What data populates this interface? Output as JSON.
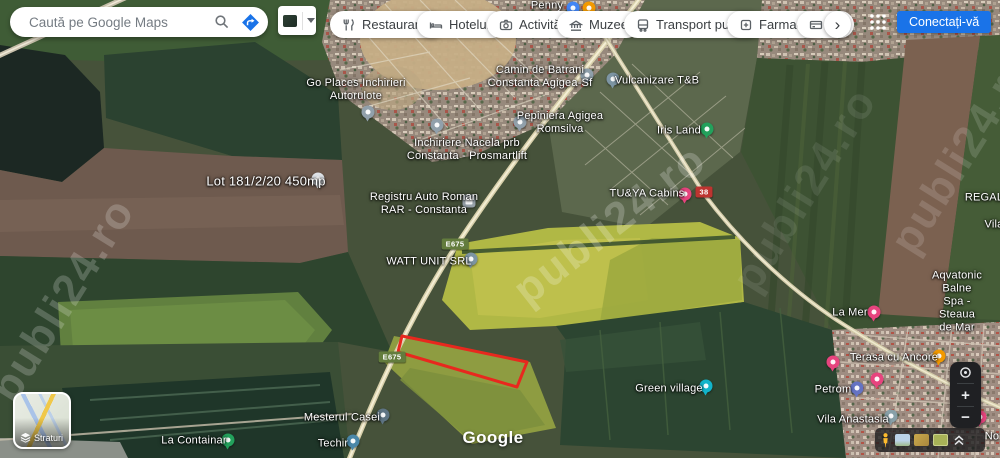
{
  "app": {
    "title": "Google Maps satellite view"
  },
  "header": {
    "search": {
      "placeholder": "Caută pe Google Maps"
    },
    "chips": [
      {
        "label": "Restaurante",
        "icon": "restaurants-icon"
      },
      {
        "label": "Hoteluri",
        "icon": "hotels-icon"
      },
      {
        "label": "Activități",
        "icon": "activities-icon"
      },
      {
        "label": "Muzee",
        "icon": "museums-icon"
      },
      {
        "label": "Transport public",
        "icon": "transit-icon"
      },
      {
        "label": "Farmacii",
        "icon": "pharmacies-icon"
      },
      {
        "label": "Ba",
        "icon": "atm-icon",
        "truncated": true
      }
    ],
    "chips_scroll": "›",
    "signin_label": "Conectați-vă"
  },
  "map": {
    "google_watermark": "Google",
    "site_watermark": "publi24.ro",
    "area_outline_points": "402,336 527,362 517,387 398,352",
    "area_outline_color": "#e8281e",
    "road_badges": [
      {
        "text": "E675",
        "x": 455,
        "y": 244,
        "style": "european"
      },
      {
        "text": "E675",
        "x": 392,
        "y": 357,
        "style": "european"
      },
      {
        "text": "38",
        "x": 704,
        "y": 192,
        "style": "national"
      }
    ],
    "labels": [
      {
        "text": "Penny",
        "x": 547,
        "y": 6
      },
      {
        "text": "Go Places Inchirieri\nAutorulote",
        "x": 356,
        "y": 90
      },
      {
        "text": "Camin de Batrani\nConstanta Agigea-Sf",
        "x": 540,
        "y": 77
      },
      {
        "text": "Vulcanizare T&B",
        "x": 657,
        "y": 81
      },
      {
        "text": "Pepiniera Agigea\nRomsilva",
        "x": 560,
        "y": 123
      },
      {
        "text": "Iris Land",
        "x": 679,
        "y": 131
      },
      {
        "text": "Inchiriere Nacela prb\nConstanta - Prosmartlift",
        "x": 467,
        "y": 150
      },
      {
        "text": "Lot 181/2/20 450mp",
        "x": 266,
        "y": 181
      },
      {
        "text": "Registru Auto Roman\nRAR - Constanta",
        "x": 424,
        "y": 204
      },
      {
        "text": "TU&YA Cabins",
        "x": 647,
        "y": 194
      },
      {
        "text": "WATT UNIT SRL",
        "x": 429,
        "y": 262
      },
      {
        "text": "REGAL",
        "x": 984,
        "y": 198
      },
      {
        "text": "Vila",
        "x": 994,
        "y": 225
      },
      {
        "text": "Aqvatonic Balne\nSpa - Steaua de Mar",
        "x": 957,
        "y": 302
      },
      {
        "text": "La Mer",
        "x": 850,
        "y": 313
      },
      {
        "text": "Terasa cu Ancore",
        "x": 894,
        "y": 358
      },
      {
        "text": "Green village",
        "x": 669,
        "y": 389
      },
      {
        "text": "Petrom",
        "x": 833,
        "y": 390
      },
      {
        "text": "Vila Anastasia",
        "x": 853,
        "y": 420
      },
      {
        "text": "Mesterul Casei",
        "x": 342,
        "y": 418
      },
      {
        "text": "La Containar",
        "x": 194,
        "y": 441
      },
      {
        "text": "Techir",
        "x": 333,
        "y": 444
      },
      {
        "text": "No",
        "x": 992,
        "y": 437
      }
    ],
    "pins": [
      {
        "name": "penny-shopping-pin",
        "color": "#4285f4",
        "x": 573,
        "y": 8
      },
      {
        "name": "orange-marker-pin",
        "color": "#f29900",
        "x": 589,
        "y": 8
      },
      {
        "name": "go-places-pin",
        "color": "#91a0ab",
        "x": 368,
        "y": 112
      },
      {
        "name": "camin-pin",
        "color": "#8fa0ab",
        "x": 587,
        "y": 75
      },
      {
        "name": "vulcanizare-pin",
        "color": "#7d95a3",
        "x": 613,
        "y": 79
      },
      {
        "name": "pepiniera-pin",
        "color": "#91a0ab",
        "x": 520,
        "y": 122
      },
      {
        "name": "nacela-pin",
        "color": "#91a0ab",
        "x": 437,
        "y": 125
      },
      {
        "name": "iris-land-park-pin",
        "color": "#23a15c",
        "x": 707,
        "y": 129
      },
      {
        "name": "lot-pin",
        "color": "#dfe3e8",
        "x": 318,
        "y": 179
      },
      {
        "name": "registru-building-icon",
        "color": "#97a1a9",
        "x": 469,
        "y": 201
      },
      {
        "name": "tuya-hotel-pin",
        "color": "#e7447e",
        "x": 685,
        "y": 194
      },
      {
        "name": "watt-unit-pin",
        "color": "#7d95a3",
        "x": 471,
        "y": 259
      },
      {
        "name": "la-mer-hotel-pin",
        "color": "#e7447e",
        "x": 874,
        "y": 312
      },
      {
        "name": "town-hotel-pin",
        "color": "#e7447e",
        "x": 833,
        "y": 362
      },
      {
        "name": "terasa-restaurant-pin",
        "color": "#f29900",
        "x": 939,
        "y": 356
      },
      {
        "name": "green-village-pin",
        "color": "#12b5cb",
        "x": 706,
        "y": 386
      },
      {
        "name": "petrom-gas-pin",
        "color": "#6573c3",
        "x": 857,
        "y": 388
      },
      {
        "name": "hotel-pin-2",
        "color": "#e7447e",
        "x": 877,
        "y": 379
      },
      {
        "name": "vila-anastasia-pin",
        "color": "#87a0a8",
        "x": 891,
        "y": 416
      },
      {
        "name": "hotel-pin-3",
        "color": "#e7447e",
        "x": 980,
        "y": 417
      },
      {
        "name": "mesterul-casei-pin",
        "color": "#5e7483",
        "x": 383,
        "y": 415
      },
      {
        "name": "techir-pin",
        "color": "#4a87a8",
        "x": 353,
        "y": 441
      },
      {
        "name": "la-containar-pin",
        "color": "#23a15c",
        "x": 228,
        "y": 440
      }
    ]
  },
  "controls": {
    "layers_label": "Straturi",
    "zoom_in_label": "+",
    "zoom_out_label": "−"
  },
  "colors": {
    "signin_blue": "#1a73e8",
    "route_badge_green": "#637c3d",
    "road_badge_red": "#bd3430",
    "area_outline_red": "#e8281e"
  }
}
